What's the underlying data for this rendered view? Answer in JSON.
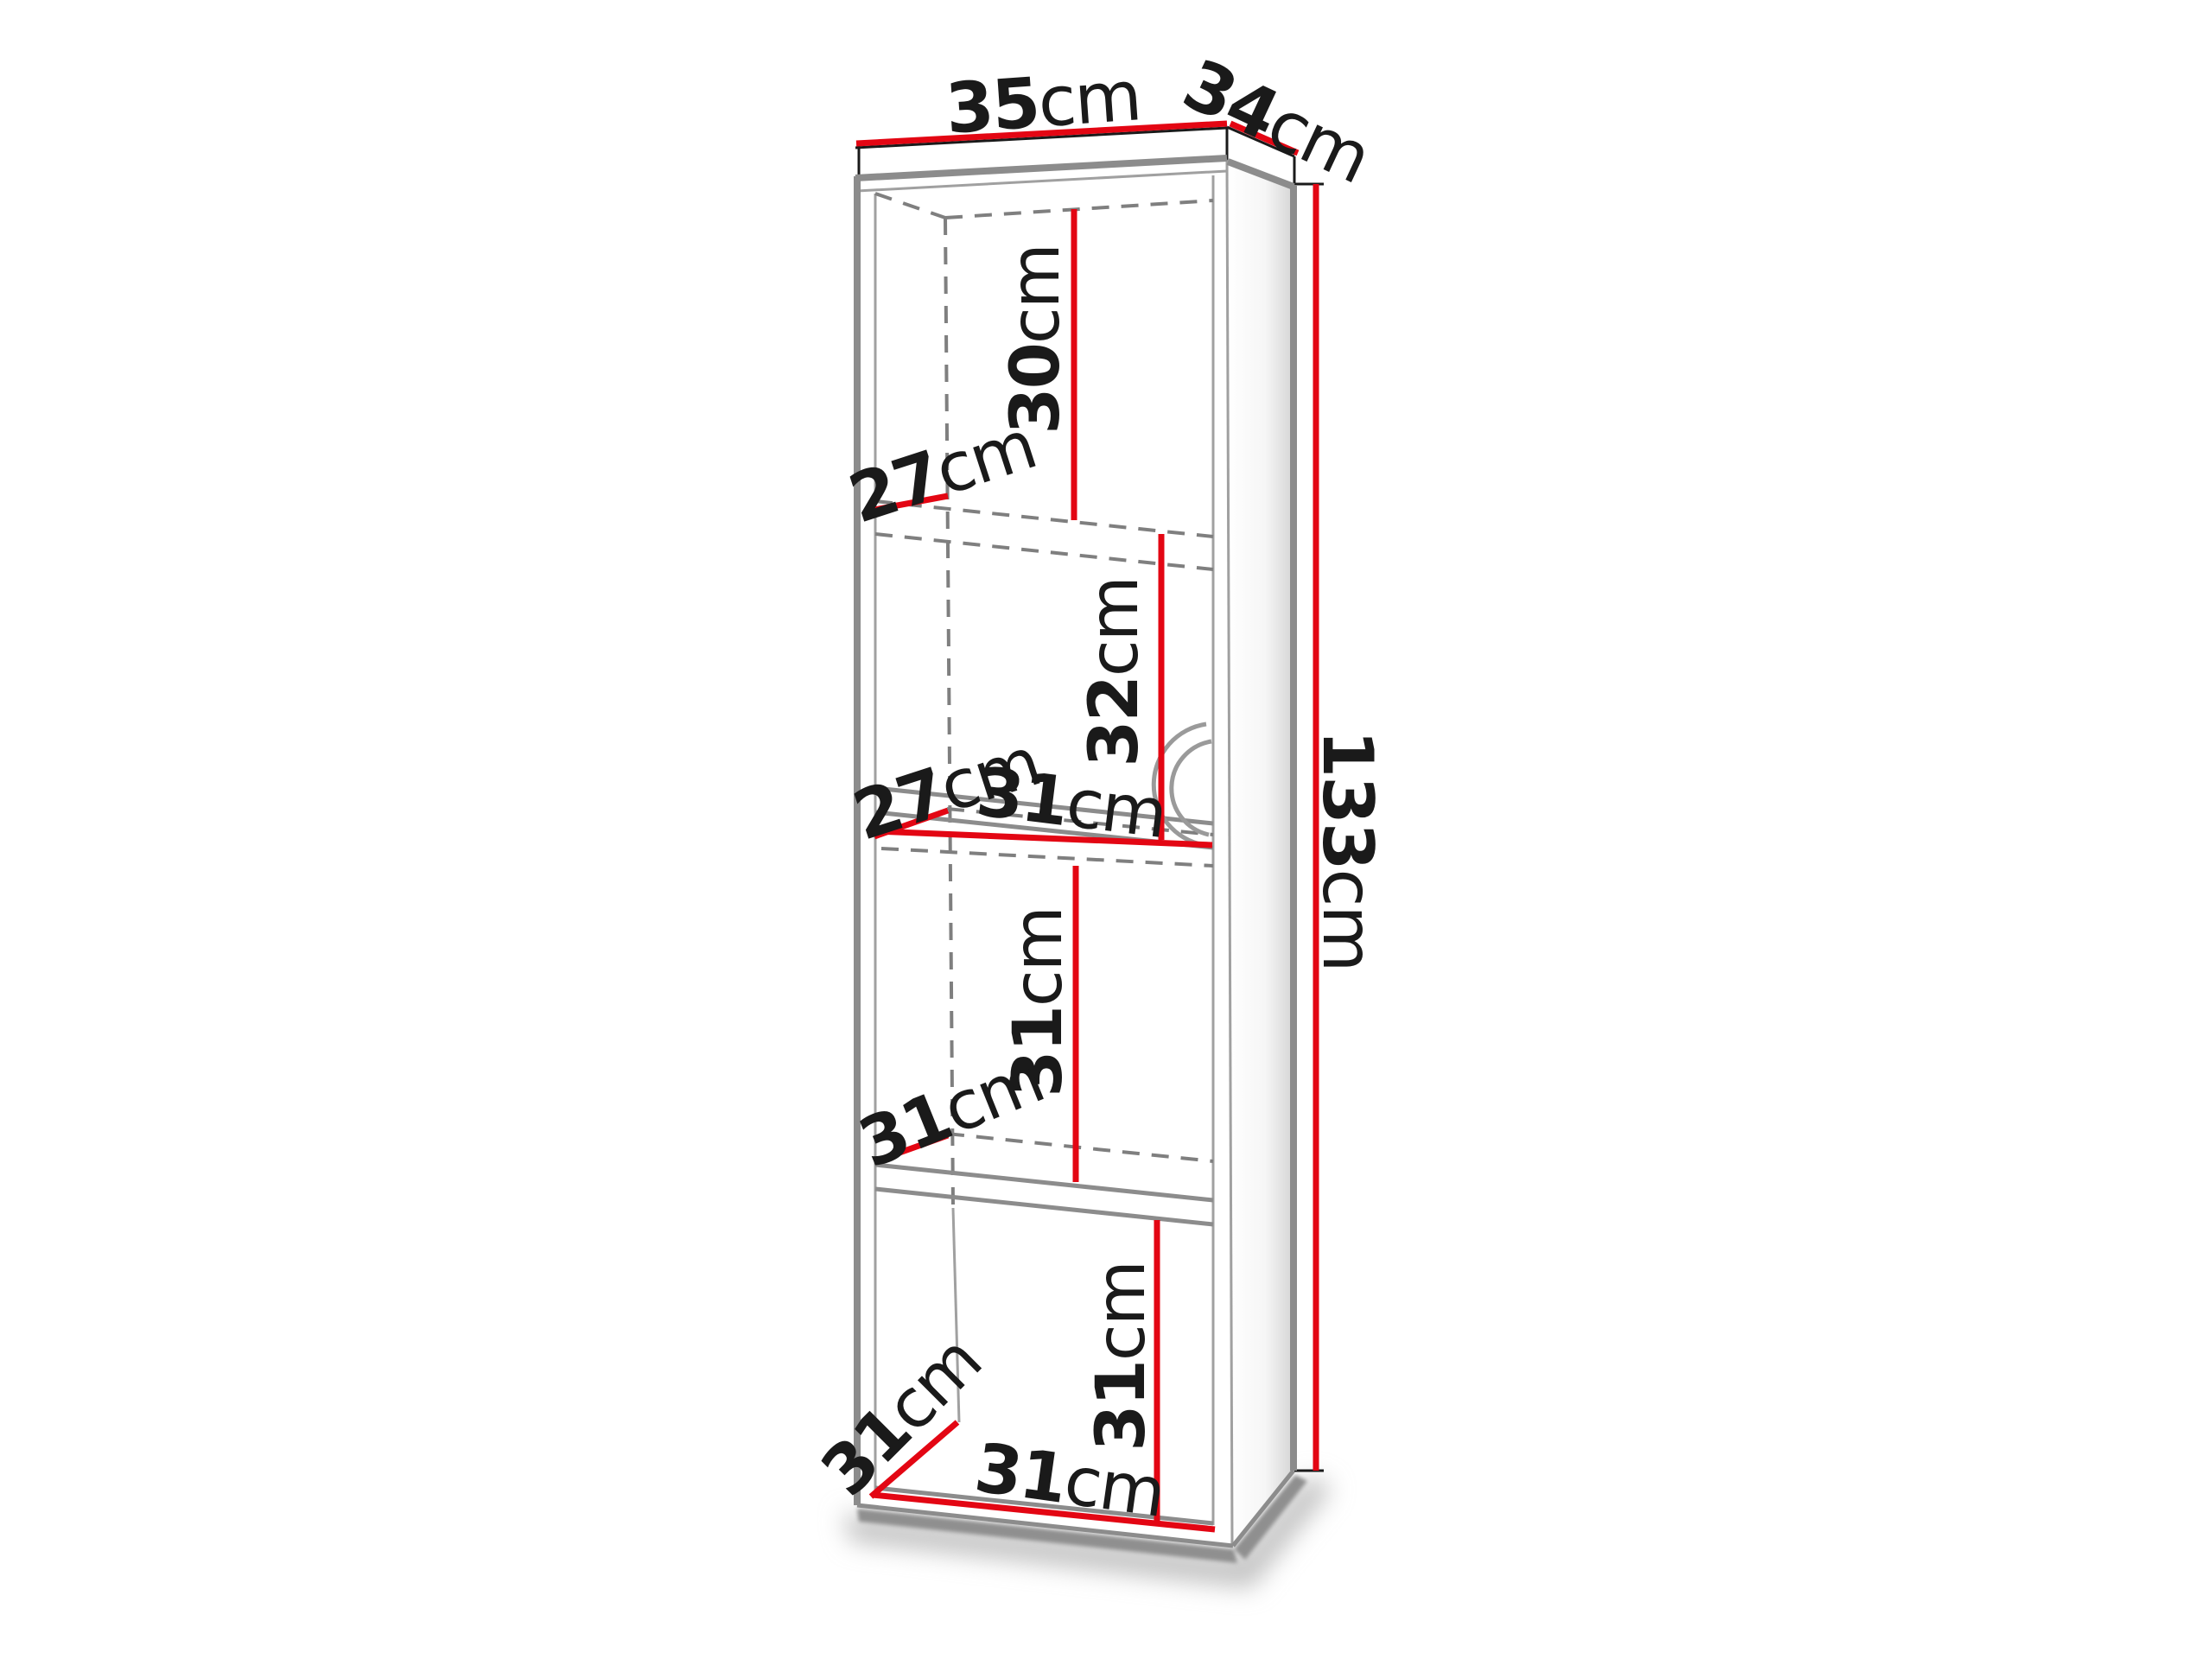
{
  "diagram": {
    "kind": "furniture-dimension-diagram",
    "subject": "tall narrow cabinet with four open compartments",
    "colors": {
      "accent_red": "#e30613",
      "outline_gray": "#8c8c8c",
      "dashed_gray": "#7f7f7f",
      "text_black": "#1a1a1a",
      "background": "#ffffff"
    },
    "dims": {
      "top_width": {
        "value": "35",
        "unit": "cm"
      },
      "top_depth": {
        "value": "34",
        "unit": "cm"
      },
      "total_height": {
        "value": "133",
        "unit": "cm"
      },
      "comp1_height": {
        "value": "30",
        "unit": "cm"
      },
      "comp1_depth": {
        "value": "27",
        "unit": "cm"
      },
      "comp2_height": {
        "value": "32",
        "unit": "cm"
      },
      "comp2_depth": {
        "value": "27",
        "unit": "cm"
      },
      "comp2_width": {
        "value": "31",
        "unit": "cm"
      },
      "comp3_height": {
        "value": "31",
        "unit": "cm"
      },
      "comp3_depth": {
        "value": "31",
        "unit": "cm"
      },
      "comp4_height": {
        "value": "31",
        "unit": "cm"
      },
      "comp4_width": {
        "value": "31",
        "unit": "cm"
      },
      "comp4_depth": {
        "value": "31",
        "unit": "cm"
      }
    }
  }
}
